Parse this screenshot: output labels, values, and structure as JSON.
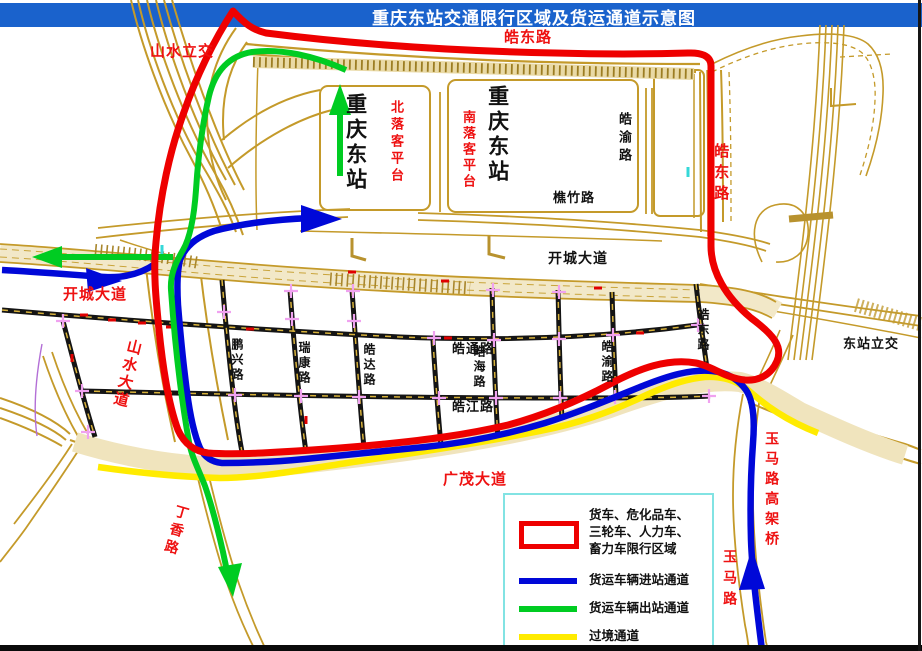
{
  "title": {
    "text": "重庆东站交通限行区域及货运通道示意图"
  },
  "colors": {
    "title_bar": "#1a62cc",
    "title_text": "#ffffff",
    "restriction": "#ee0000",
    "entry_channel": "#0008d8",
    "exit_channel": "#00cc22",
    "transit_channel": "#ffeb00",
    "road_tan": "#c49a2a",
    "label_red": "#ee1111",
    "label_black": "#111111",
    "legend_border": "#82e3e3",
    "intersection_cross": "#f0a2f0"
  },
  "legend": {
    "items": [
      {
        "symbol": "restriction-area",
        "lines": [
          "货车、危化品车、",
          "三轮车、人力车、",
          "畜力车限行区域"
        ]
      },
      {
        "symbol": "entry-channel",
        "lines": [
          "货运车辆进站通道"
        ]
      },
      {
        "symbol": "exit-channel",
        "lines": [
          "货运车辆出站通道"
        ]
      },
      {
        "symbol": "transit-channel",
        "lines": [
          "过境通道"
        ]
      }
    ]
  },
  "labels": [
    {
      "id": "shanshui-interchange",
      "text": "山水立交",
      "color": "red",
      "o": "h",
      "x": 150,
      "y": 44,
      "size": 15,
      "ls": 1
    },
    {
      "id": "haodong-rd-top",
      "text": "皓东路",
      "color": "red",
      "o": "h",
      "x": 504,
      "y": 30,
      "size": 15,
      "ls": 1
    },
    {
      "id": "haodong-rd-east",
      "text": "皓东路",
      "color": "red",
      "o": "v",
      "x": 712,
      "y": 143,
      "size": 15,
      "ls": 6
    },
    {
      "id": "north-platform",
      "text": "北落客平台",
      "color": "red",
      "o": "v",
      "x": 389,
      "y": 100,
      "size": 13,
      "ls": 4
    },
    {
      "id": "south-platform",
      "text": "南落客平台",
      "color": "red",
      "o": "v",
      "x": 461,
      "y": 110,
      "size": 13,
      "ls": 3
    },
    {
      "id": "station-name-1",
      "text": "重庆东站",
      "color": "black",
      "o": "v",
      "x": 343,
      "y": 93,
      "size": 21,
      "ls": 4
    },
    {
      "id": "station-name-2",
      "text": "重庆东站",
      "color": "black",
      "o": "v",
      "x": 485,
      "y": 85,
      "size": 21,
      "ls": 4
    },
    {
      "id": "haoyu-rd-north",
      "text": "皓渝路",
      "color": "black",
      "o": "v",
      "x": 617,
      "y": 112,
      "size": 13,
      "ls": 5
    },
    {
      "id": "qiaozhu-rd",
      "text": "樵竹路",
      "color": "black",
      "o": "h",
      "x": 553,
      "y": 191,
      "size": 13,
      "ls": 1
    },
    {
      "id": "kaicheng-ave-black",
      "text": "开城大道",
      "color": "black",
      "o": "h",
      "x": 548,
      "y": 251,
      "size": 14,
      "ls": 1
    },
    {
      "id": "kaicheng-ave-red",
      "text": "开城大道",
      "color": "red",
      "o": "h",
      "x": 63,
      "y": 287,
      "size": 15,
      "ls": 1
    },
    {
      "id": "shanshui-ave",
      "text": "山水大道",
      "color": "red",
      "o": "v",
      "x": 127,
      "y": 337,
      "size": 15,
      "ls": 3,
      "rot": 14
    },
    {
      "id": "pengxing-rd",
      "text": "鹏兴路",
      "color": "black",
      "o": "v",
      "x": 230,
      "y": 338,
      "size": 12,
      "ls": 3
    },
    {
      "id": "ruikang-rd",
      "text": "瑞康路",
      "color": "black",
      "o": "v",
      "x": 297,
      "y": 341,
      "size": 12,
      "ls": 3
    },
    {
      "id": "haoda-rd",
      "text": "皓达路",
      "color": "black",
      "o": "v",
      "x": 362,
      "y": 343,
      "size": 12,
      "ls": 3
    },
    {
      "id": "haotong-rd",
      "text": "皓通路",
      "color": "black",
      "o": "h",
      "x": 452,
      "y": 342,
      "size": 13,
      "ls": 1
    },
    {
      "id": "haohai-rd",
      "text": "皓海路",
      "color": "black",
      "o": "v",
      "x": 472,
      "y": 345,
      "size": 12,
      "ls": 3
    },
    {
      "id": "haojiang-rd",
      "text": "皓江路",
      "color": "black",
      "o": "h",
      "x": 452,
      "y": 400,
      "size": 13,
      "ls": 1
    },
    {
      "id": "haoyu-rd-grid",
      "text": "皓渝路",
      "color": "black",
      "o": "v",
      "x": 600,
      "y": 340,
      "size": 12,
      "ls": 3
    },
    {
      "id": "haodong-rd-grid",
      "text": "皓东路",
      "color": "black",
      "o": "v",
      "x": 696,
      "y": 308,
      "size": 12,
      "ls": 3
    },
    {
      "id": "dongzhan-interchange",
      "text": "东站立交",
      "color": "black",
      "o": "h",
      "x": 843,
      "y": 337,
      "size": 13,
      "ls": 1
    },
    {
      "id": "guangmao-ave",
      "text": "广茂大道",
      "color": "red",
      "o": "h",
      "x": 443,
      "y": 472,
      "size": 15,
      "ls": 1
    },
    {
      "id": "dingxiang-rd",
      "text": "丁香路",
      "color": "red",
      "o": "v",
      "x": 176,
      "y": 503,
      "size": 14,
      "ls": 4,
      "rot": 16
    },
    {
      "id": "yuma-viaduct",
      "text": "玉马路高架桥",
      "color": "red",
      "o": "v",
      "x": 764,
      "y": 431,
      "size": 14,
      "ls": 6
    },
    {
      "id": "yuma-rd",
      "text": "玉马路",
      "color": "red",
      "o": "v",
      "x": 722,
      "y": 549,
      "size": 14,
      "ls": 7
    }
  ]
}
